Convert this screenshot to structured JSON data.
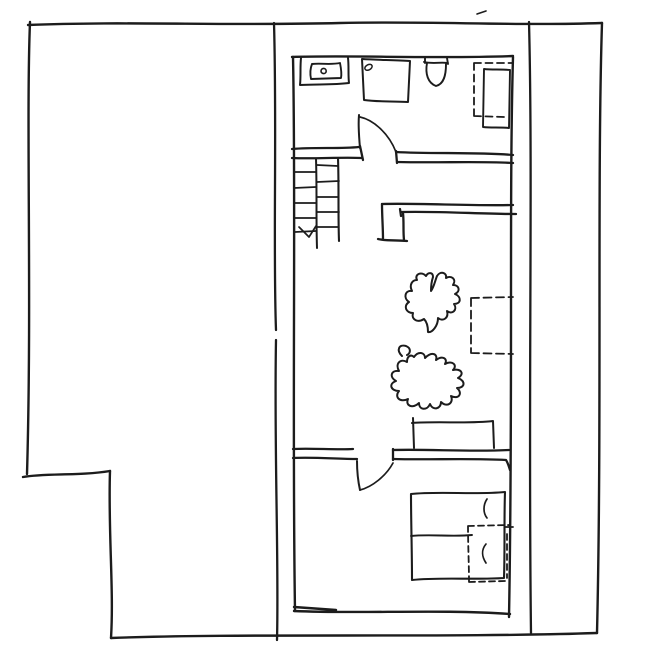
{
  "canvas": {
    "width": 648,
    "height": 664,
    "background": "#ffffff",
    "ink": "#1c1c1c",
    "default_stroke_width": 2.2
  },
  "drawing": {
    "description": "hand-drawn architectural floor plan sketch, no text labels",
    "elements": [
      {
        "name": "site-boundary-top",
        "d": "M28,25 C120,21 230,26 340,23 C430,21 520,26 602,23",
        "w": 2.4
      },
      {
        "name": "site-boundary-left",
        "d": "M30,22 C26,120 32,300 27,474",
        "w": 2.4
      },
      {
        "name": "site-notch-horizontal",
        "d": "M23,477 C45,473 80,476 110,471",
        "w": 2.4
      },
      {
        "name": "site-notch-vertical",
        "d": "M110,471 C108,530 114,590 111,638",
        "w": 2.4
      },
      {
        "name": "site-boundary-bottom",
        "d": "M111,638 C240,633 450,638 597,633",
        "w": 2.4
      },
      {
        "name": "site-boundary-right",
        "d": "M602,23 C597,180 602,420 597,633",
        "w": 2.4
      },
      {
        "name": "fence-line-left",
        "d": "M274,23 C277,130 273,250 276,330 M276,340 C274,450 279,560 277,640",
        "w": 2.3
      },
      {
        "name": "fence-line-right",
        "d": "M529,22 C533,180 528,400 531,633",
        "w": 2.3
      },
      {
        "name": "wall-top",
        "d": "M292,57 C350,55 440,59 513,56",
        "w": 2.4
      },
      {
        "name": "wall-left",
        "d": "M293,57 C296,200 292,420 295,611",
        "w": 2.4
      },
      {
        "name": "wall-right",
        "d": "M513,57 C509,200 513,400 509,617",
        "w": 2.4
      },
      {
        "name": "wall-bedroom-bottom",
        "d": "M294,611 C360,614 440,609 510,614 M294,607 C308,608 322,609 336,610",
        "w": 2.4
      },
      {
        "name": "wall-bath-left-outer",
        "d": "M292,149 C315,147 340,149 359,147",
        "w": 2.3
      },
      {
        "name": "wall-bath-left-inner",
        "d": "M292,158 C315,159 340,157 362,158",
        "w": 2.3
      },
      {
        "name": "wall-bath-left-cap",
        "d": "M360,146 L363,160",
        "w": 2.3
      },
      {
        "name": "bathroom-door-leaf",
        "d": "M359,115 C358,126 359,137 360,148",
        "w": 2.0
      },
      {
        "name": "bathroom-door-arc",
        "d": "M360,117 C374,120 389,134 396,152",
        "w": 1.7
      },
      {
        "name": "wall-bath-right-outer",
        "d": "M396,152 C430,154 480,152 513,155",
        "w": 2.3
      },
      {
        "name": "wall-bath-right-inner",
        "d": "M397,162 C440,163 480,161 513,163",
        "w": 2.3
      },
      {
        "name": "wall-bath-right-cap",
        "d": "M396,151 L397,163",
        "w": 2.3
      },
      {
        "name": "sink-vanity-counter",
        "d": "M301,58 C300,67 301,76 300,85 C316,84 333,85 349,83 C348,75 349,66 348,58",
        "w": 2.0
      },
      {
        "name": "sink-basin",
        "d": "M312,64 C310,69 310,74 311,79 L341,78 C342,73 341,68 340,63 C331,65 321,63 312,64 Z",
        "w": 1.9
      },
      {
        "name": "sink-faucet-dot",
        "d": "M321,71 a2.6,2.6 0 1,0 5.2,0 a2.6,2.6 0 1,0 -5.2,0",
        "w": 1.6
      },
      {
        "name": "shower-tray",
        "d": "M362,59 C378,60 395,60 410,61 L408,102 C393,101 378,102 364,100 Z",
        "w": 2.0
      },
      {
        "name": "shower-drain",
        "d": "M365,69 a3.6,2.4 -28 1,0 7,-3.4 a3.6,2.4 -28 1,0 -7,3.4",
        "w": 1.5
      },
      {
        "name": "toilet",
        "d": "M425,58 L425,63 M447,58 L448,64 M424,62 C432,64 440,62 448,63 M427,63 C425,74 428,83 436,86 C444,84 446,75 446,64",
        "w": 1.9
      },
      {
        "name": "bath-closet-dashed-outline",
        "d": "M474,63 L513,63 M474,63 C474,81 474,99 474,116 M474,116 L505,117",
        "w": 1.8,
        "dash": "7 4.5"
      },
      {
        "name": "bath-dresser",
        "d": "M484,69 C492,70 501,69 510,70 L509,128 C500,127 491,128 483,127 Z",
        "w": 1.9
      },
      {
        "name": "stairs-right-rail",
        "d": "M338,158 C339,186 338,214 339,241",
        "w": 2.1
      },
      {
        "name": "stairs-mid-rail",
        "d": "M316,159 C317,189 316,219 317,248",
        "w": 2.0
      },
      {
        "name": "stairs-treads",
        "d": "M294,172 L316,172 M294,188 L316,187 M294,203 L316,203 M295,218 L316,218 M295,232 L316,231 M317,165 L338,166 M317,182 L339,181 M317,197 L338,197 M317,212 L339,212 M317,227 L338,227",
        "w": 1.7
      },
      {
        "name": "stairs-direction-arrow",
        "d": "M299,227 L309,237 L316,226",
        "w": 1.7
      },
      {
        "name": "wall-stairwell-top",
        "d": "M382,204 C420,203 470,206 513,205",
        "w": 2.3
      },
      {
        "name": "wall-stairwell-stub",
        "d": "M382,204 C382,216 383,228 383,239 M378,239 C387,241 397,240 407,241 M404,240 C403,231 404,222 403,213",
        "w": 2.3
      },
      {
        "name": "wall-stairwell-bottom",
        "d": "M401,212 C440,211 480,214 516,214 M400,209 L401,216",
        "w": 2.3
      },
      {
        "name": "plant-upper",
        "d": "M417,280 C414,274 422,271 426,276 C428,272 433,272 433,277 C431,283 431,287 431,291 C434,287 435,281 437,276 C440,271 447,272 446,278 C451,275 457,279 453,285 C459,285 461,291 455,294 C462,297 461,304 454,304 C458,310 452,315 447,311 C449,318 443,322 438,318 C438,326 432,333 428,332 C428,327 427,322 424,319 C418,323 411,320 413,313 C406,313 403,306 409,302 C403,298 405,290 412,291 C409,285 412,280 417,280 Z",
        "w": 2.0
      },
      {
        "name": "plant-lower",
        "d": "M414,357 C418,351 425,352 425,358 C432,351 438,354 436,360 C443,355 448,359 445,364 C452,360 458,365 453,370 C461,368 465,374 458,378 C466,381 465,388 457,388 C463,393 459,400 451,396 C454,403 447,408 441,402 C441,409 433,411 430,404 C427,411 419,410 419,403 C413,409 405,406 408,399 C400,403 394,397 399,391 C391,391 388,384 396,381 C389,377 391,370 399,371 C395,364 400,358 407,362 C407,356 411,354 414,357 Z",
        "w": 2.0
      },
      {
        "name": "plant-lower-curl",
        "d": "M402,356 C396,350 399,344 406,346 C411,348 411,353 407,355",
        "w": 2.0
      },
      {
        "name": "living-dashed-box",
        "d": "M471,298 L513,297 M471,298 C471,317 471,336 471,353 M471,353 L513,354",
        "w": 1.8,
        "dash": "8 4.5"
      },
      {
        "name": "sideboard",
        "d": "M413,418 L414,448 M412,423 C440,421 468,424 493,421 M493,421 L494,448",
        "w": 2.0
      },
      {
        "name": "wall-bedroom-left-outer",
        "d": "M293,449 C313,448 335,450 353,449",
        "w": 2.3
      },
      {
        "name": "wall-bedroom-left-inner",
        "d": "M293,458 C315,457 337,459 357,459",
        "w": 2.3
      },
      {
        "name": "bedroom-door-leaf",
        "d": "M357,461 C357,471 358,481 360,490",
        "w": 2.0
      },
      {
        "name": "bedroom-door-arc",
        "d": "M360,490 C372,487 386,476 393,463",
        "w": 1.7
      },
      {
        "name": "wall-bedroom-right-outer",
        "d": "M393,450 C430,449 470,452 509,450",
        "w": 2.3
      },
      {
        "name": "wall-bedroom-right-inner",
        "d": "M393,459 C430,460 470,458 506,460 C508,463 509,467 510,470",
        "w": 2.3
      },
      {
        "name": "wall-bedroom-right-cap",
        "d": "M393,449 L393,460",
        "w": 2.3
      },
      {
        "name": "bed-frame",
        "d": "M411,494 C440,491 475,495 505,492 C504,520 505,550 504,578 C475,580 440,577 412,580 C412,550 411,522 411,494 Z",
        "w": 2.1
      },
      {
        "name": "bed-center-line",
        "d": "M411,536 C430,534 452,537 472,535",
        "w": 1.9
      },
      {
        "name": "pillow-crease-top",
        "d": "M487,499 C483,505 483,513 487,518",
        "w": 1.7
      },
      {
        "name": "pillow-crease-bottom",
        "d": "M486,544 C481,550 482,557 486,563",
        "w": 1.7
      },
      {
        "name": "bed-closet-dashed-outline",
        "d": "M468,526 L510,525 M468,526 C468,545 469,564 469,582 M469,582 L505,581 M507,534 L507,578",
        "w": 1.8,
        "dash": "6 4"
      },
      {
        "name": "bed-wall-tick",
        "d": "M505,527 L513,527",
        "w": 1.8
      },
      {
        "name": "stray-pen-mark",
        "d": "M477,14 L486,11",
        "w": 1.6
      }
    ]
  }
}
